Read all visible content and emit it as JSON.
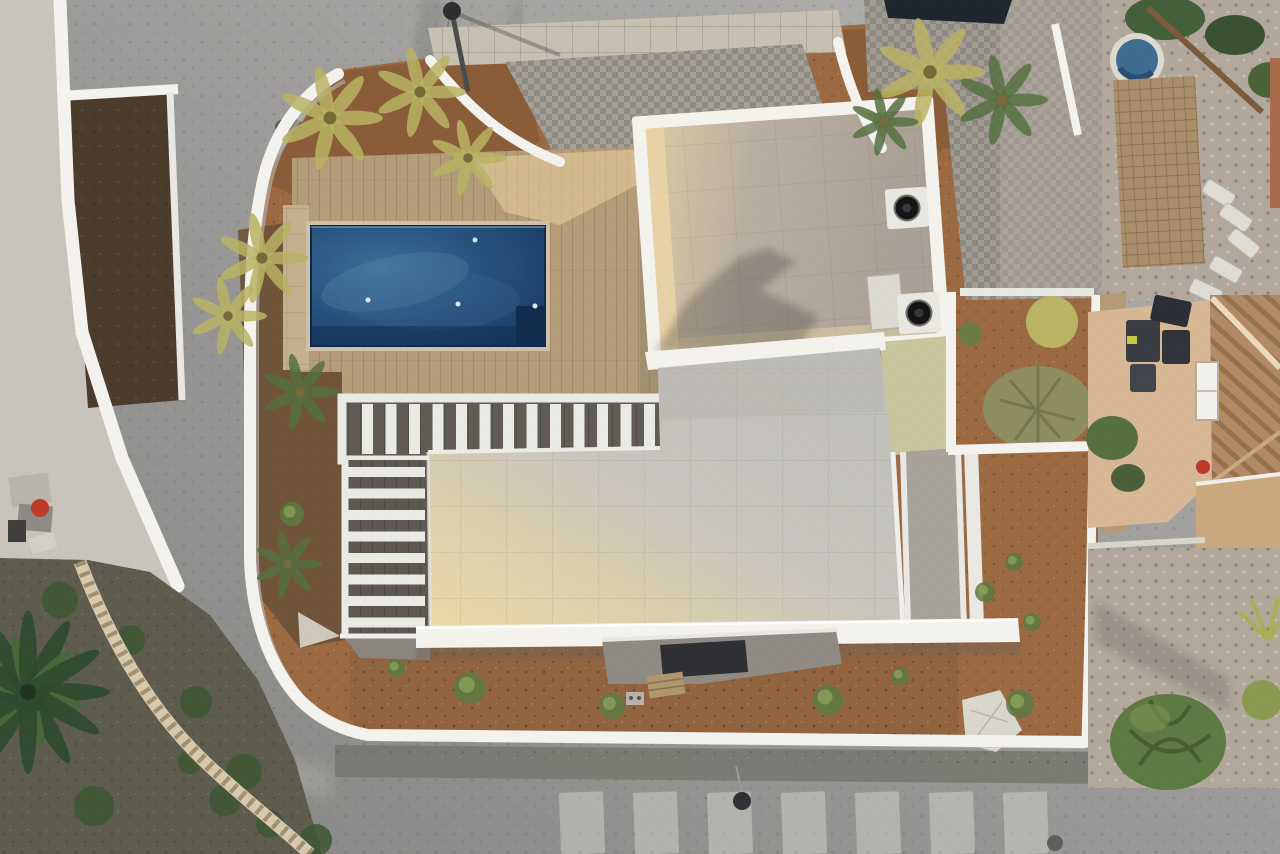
{
  "scene": {
    "title": "aerial-drone-view-modern-villa-with-pool",
    "elements": {
      "roads": "asphalt streets on left and bottom with faded crosswalk",
      "villa": "white flat-roof villa with two roof terraces",
      "pool": "rectangular dark-blue swimming pool with wooden deck",
      "pergola": "white slatted pergola and stair treads",
      "gardens": "bare brown dirt gardens with young shrubs",
      "neighbors": "neighbouring houses: grey tiled roof, terracotta roof, gravel gardens, palm trees"
    }
  },
  "palette": {
    "asphalt_light": "#b4b3b0",
    "asphalt_mid": "#9d9c9a",
    "asphalt_dark": "#858583",
    "road_streak": "#6f6f6d",
    "curb_dark": "#77766f",
    "crosswalk": "#d3d1c9",
    "concrete": "#c8c4bb",
    "white_wall": "#f3f2ee",
    "wall_shadow": "#b9b8b4",
    "scallop_wall": "#d6c9ad",
    "dirt": "#9c6a42",
    "dirt_planter": "#8a5c38",
    "dirt_mulch": "#6b523a",
    "deck_wood": "#b49c79",
    "deck_sunlit": "#e6cd9c",
    "stone_pillar": "#c4b08f",
    "gray_plank": "#605c55",
    "pergola_white": "#e9eae6",
    "pool_light": "#3c6e98",
    "pool_mid": "#26517d",
    "pool_deep": "#16365c",
    "pool_edge": "#122c4e",
    "pool_coping": "#cdbfa8",
    "terrace_sunlit": "#eed9a6",
    "terrace_warm": "#dccfab",
    "terrace": "#c7c4be",
    "terrace_cool": "#c2c0bb",
    "fascia": "#f4f2ec",
    "roof_sunlit": "#dcc9a5",
    "upper_roof": "#b9ae9f",
    "roof_cool": "#a8a094",
    "roof_shadow": "#4e4a45",
    "cobble_roof": "#a19c93",
    "solar_panel": "#20262e",
    "vent_black": "#141414",
    "vent_base": "#e9e7e1",
    "greenish_wall": "#c9c59b",
    "balcony": "#a7a29a",
    "terracotta": "#b28a66",
    "terracotta_dark": "#96714c",
    "beige_house": "#d8b795",
    "window_white": "#f1f0ec",
    "window_dark": "#2f3034",
    "tank_dark": "#3a3d43",
    "gravel": "#b1a89b",
    "paver_tan": "#a88e6a",
    "bush_green": "#5c7a42",
    "bush_dark": "#3c5631",
    "sage_shrub": "#8d9164",
    "fern_yellow": "#b9b364",
    "fern_green": "#55703f",
    "palm_dark": "#2e4a2d",
    "palm_mid": "#49683a",
    "basin_blue": "#3f6c90",
    "tarp": "#d9d6cd",
    "red_item": "#bb3a28",
    "hedge_brown": "#4c3c2c"
  },
  "counts": {
    "pergola_slats": 13,
    "stair_treads": 8,
    "crosswalk_stripes": 7,
    "palm_fronds": 12
  },
  "scatter": {
    "fern_clusters": [
      {
        "x": 330,
        "y": 118,
        "r": 46,
        "t": "y"
      },
      {
        "x": 420,
        "y": 92,
        "r": 40,
        "t": "y"
      },
      {
        "x": 468,
        "y": 158,
        "r": 34,
        "t": "y"
      },
      {
        "x": 262,
        "y": 258,
        "r": 40,
        "t": "y"
      },
      {
        "x": 228,
        "y": 316,
        "r": 34,
        "t": "y"
      },
      {
        "x": 930,
        "y": 72,
        "r": 48,
        "t": "y"
      },
      {
        "x": 1002,
        "y": 100,
        "r": 40,
        "t": "g"
      },
      {
        "x": 884,
        "y": 122,
        "r": 30,
        "t": "g"
      },
      {
        "x": 300,
        "y": 392,
        "r": 34,
        "t": "g"
      },
      {
        "x": 288,
        "y": 564,
        "r": 30,
        "t": "g"
      }
    ],
    "grass_tufts": [
      {
        "x": 470,
        "y": 688,
        "r": 16
      },
      {
        "x": 612,
        "y": 706,
        "r": 13
      },
      {
        "x": 828,
        "y": 700,
        "r": 15
      },
      {
        "x": 1020,
        "y": 704,
        "r": 14
      },
      {
        "x": 900,
        "y": 676,
        "r": 9
      },
      {
        "x": 396,
        "y": 668,
        "r": 9
      },
      {
        "x": 292,
        "y": 514,
        "r": 12
      },
      {
        "x": 985,
        "y": 592,
        "r": 10
      },
      {
        "x": 1014,
        "y": 562,
        "r": 9
      },
      {
        "x": 1032,
        "y": 622,
        "r": 9
      }
    ],
    "loungers": [
      {
        "x": 1203,
        "y": 186,
        "rot": 32
      },
      {
        "x": 1220,
        "y": 210,
        "rot": 35
      },
      {
        "x": 1228,
        "y": 236,
        "rot": 38
      },
      {
        "x": 1210,
        "y": 262,
        "rot": 30
      },
      {
        "x": 1190,
        "y": 284,
        "rot": 25
      }
    ],
    "bottom_left_bushes": [
      {
        "x": 225,
        "y": 800,
        "r": 16
      },
      {
        "x": 270,
        "y": 824,
        "r": 14
      },
      {
        "x": 316,
        "y": 840,
        "r": 16
      },
      {
        "x": 190,
        "y": 762,
        "r": 12
      },
      {
        "x": 60,
        "y": 600,
        "r": 18
      },
      {
        "x": 130,
        "y": 640,
        "r": 15
      },
      {
        "x": 196,
        "y": 702,
        "r": 16
      },
      {
        "x": 244,
        "y": 772,
        "r": 18
      },
      {
        "x": 94,
        "y": 806,
        "r": 20
      }
    ]
  }
}
